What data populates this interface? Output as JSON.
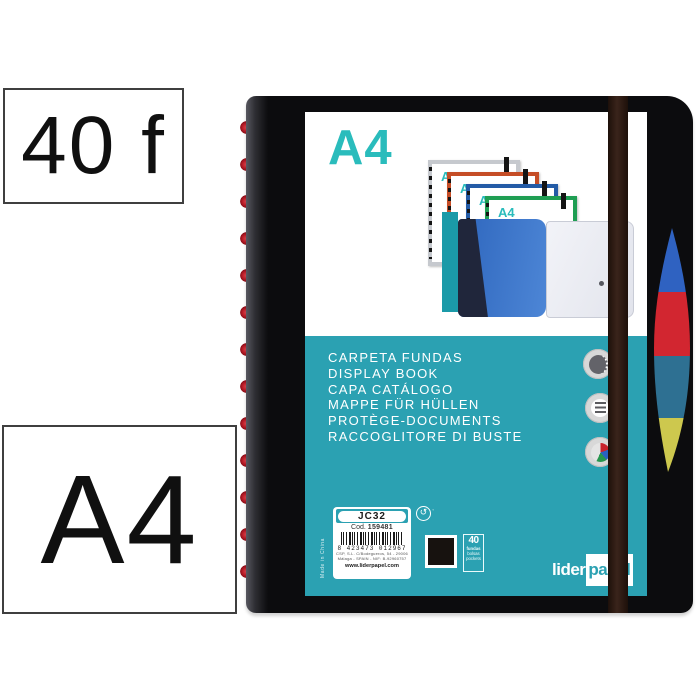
{
  "callouts": {
    "sheets": "40 f",
    "format": "A4"
  },
  "cover": {
    "format_title": "A4",
    "mini_format_label": "A4",
    "product_names": [
      "CARPETA FUNDAS",
      "DISPLAY BOOK",
      "CAPA CATÁLOGO",
      "MAPPE FÜR HÜLLEN",
      "PROTÈGE-DOCUMENTS",
      "RACCOGLITORE DI BUSTE"
    ],
    "reference": {
      "model": "JC32",
      "code_prefix": "Cod.",
      "code": "159481",
      "barcode_digits": "8 423473 012967",
      "address_line_1": "CSP, S.L. C/Bodegueros, 54 - 29006",
      "address_line_2": "Málaga - SPAIN - NIF: B-92960757",
      "website": "www.liderpapel.com"
    },
    "made_in": "Made in China",
    "quantity": {
      "value": "40",
      "unit_es": "fundas",
      "unit_pt": "bolsas",
      "unit_en": "pockets"
    },
    "brand": {
      "prefix": "lider",
      "suffix": "papel"
    },
    "badges": [
      "disc-binding-badge",
      "pockets-badge",
      "assorted-colors-badge"
    ],
    "green_dot_symbol": "↺",
    "colors": {
      "teal_band": "#2ba1b2",
      "accent_teal": "#2abcbc",
      "cover_black": "#0c0c0e",
      "elastic_brown": "#2b1710",
      "disc_red": "#c21f2b",
      "swatch_black": "#17120f",
      "tab_blue": "#2f62c1",
      "tab_red": "#d22630",
      "tab_steel": "#2e7092",
      "tab_yellow": "#cdc84e",
      "mini_frames": [
        "#c6c9ce",
        "#c54d26",
        "#235ba6",
        "#1f9e53"
      ]
    }
  }
}
